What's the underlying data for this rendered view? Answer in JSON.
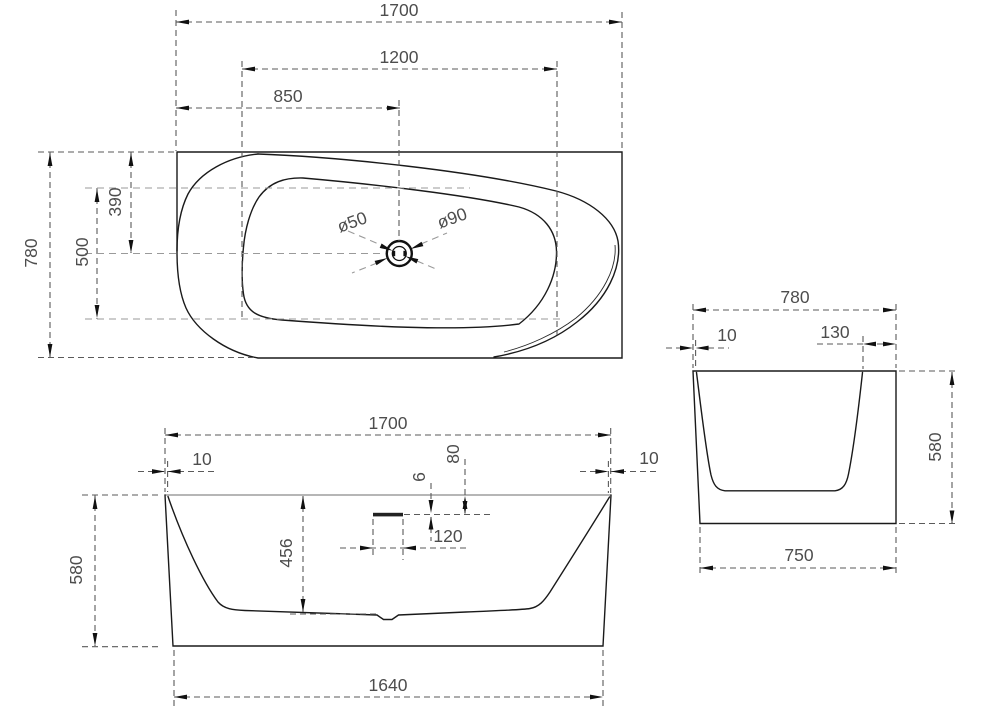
{
  "drawing": {
    "background": "#ffffff",
    "line_color": "#1a1a1a",
    "dimension_line_color": "#5a5a5a",
    "text_color": "#4d4d4d",
    "views": {
      "plan": {
        "title": "bathtub-top-view",
        "dims": {
          "overall_length": "1700",
          "basin_length": "1200",
          "drain_offset": "850",
          "overall_width": "780",
          "basin_width": "500",
          "drain_centerline": "390",
          "drain_diameter_small": "ø50",
          "drain_diameter_large": "ø90"
        }
      },
      "front": {
        "title": "bathtub-front-view",
        "dims": {
          "overall_length": "1700",
          "rim_left": "10",
          "rim_right": "10",
          "overflow_drop": "80",
          "overflow_slot_height": "6",
          "overflow_slot_width": "120",
          "inner_depth": "456",
          "overall_height": "580",
          "base_length": "1640"
        }
      },
      "side": {
        "title": "bathtub-side-view",
        "dims": {
          "overall_width": "780",
          "rim_edge": "10",
          "rim_inner": "130",
          "overall_height": "580",
          "base_width": "750"
        }
      }
    }
  }
}
